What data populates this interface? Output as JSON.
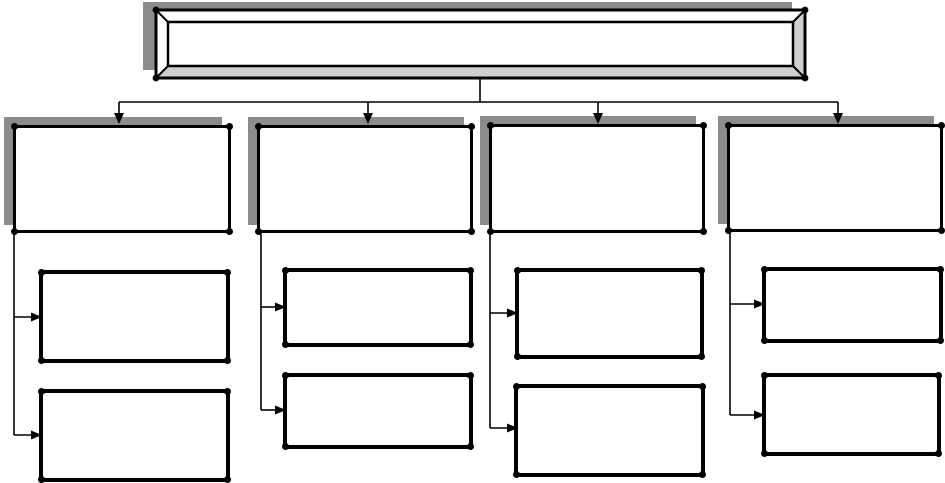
{
  "diagram": {
    "type": "hierarchy-flowchart-template",
    "title": "",
    "root": {
      "label": "",
      "style": "beveled-frame",
      "shadow": true
    },
    "branches": [
      {
        "label": "",
        "shadow": true,
        "children": [
          {
            "label": ""
          },
          {
            "label": ""
          }
        ]
      },
      {
        "label": "",
        "shadow": true,
        "children": [
          {
            "label": ""
          },
          {
            "label": ""
          }
        ]
      },
      {
        "label": "",
        "shadow": true,
        "children": [
          {
            "label": ""
          },
          {
            "label": ""
          }
        ]
      },
      {
        "label": "",
        "shadow": true,
        "children": [
          {
            "label": ""
          },
          {
            "label": ""
          }
        ]
      }
    ],
    "colors": {
      "line": "#000000",
      "box_fill": "#ffffff",
      "shadow": "#8c8c8c",
      "bevel": "#cfcfcf",
      "background": "#ffffff"
    }
  }
}
